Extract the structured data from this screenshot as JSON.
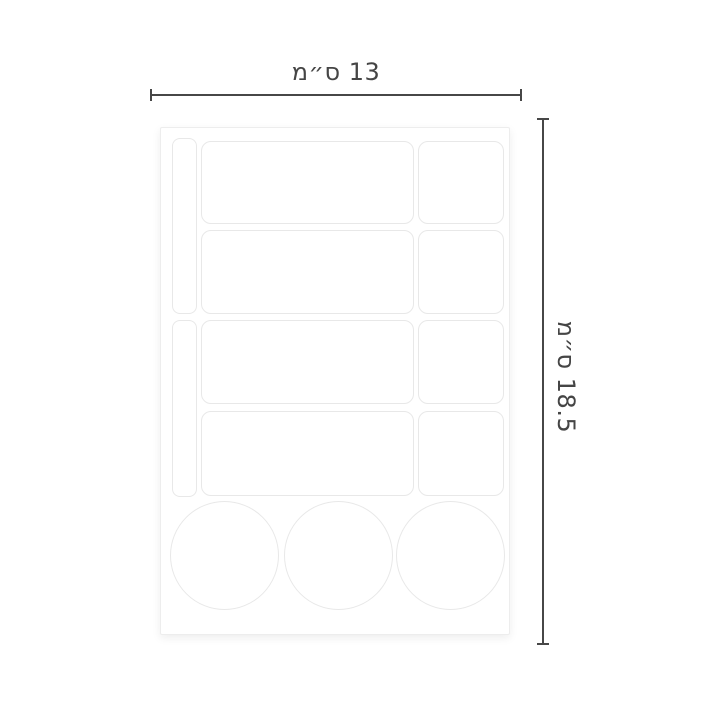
{
  "diagram": {
    "width_dimension": {
      "label": "13 ס״מ"
    },
    "height_dimension": {
      "label": "18.5 ס״מ"
    },
    "colors": {
      "dimension_line": "#474747",
      "dimension_text": "#454545",
      "sticker_outline": "#e8e8e8",
      "sheet_edge": "#ededed",
      "background": "#ffffff"
    },
    "sheet": {
      "sticker_counts": {
        "left_strips": 2,
        "large_rectangles": 4,
        "small_rectangles": 4,
        "circles": 3
      }
    }
  }
}
